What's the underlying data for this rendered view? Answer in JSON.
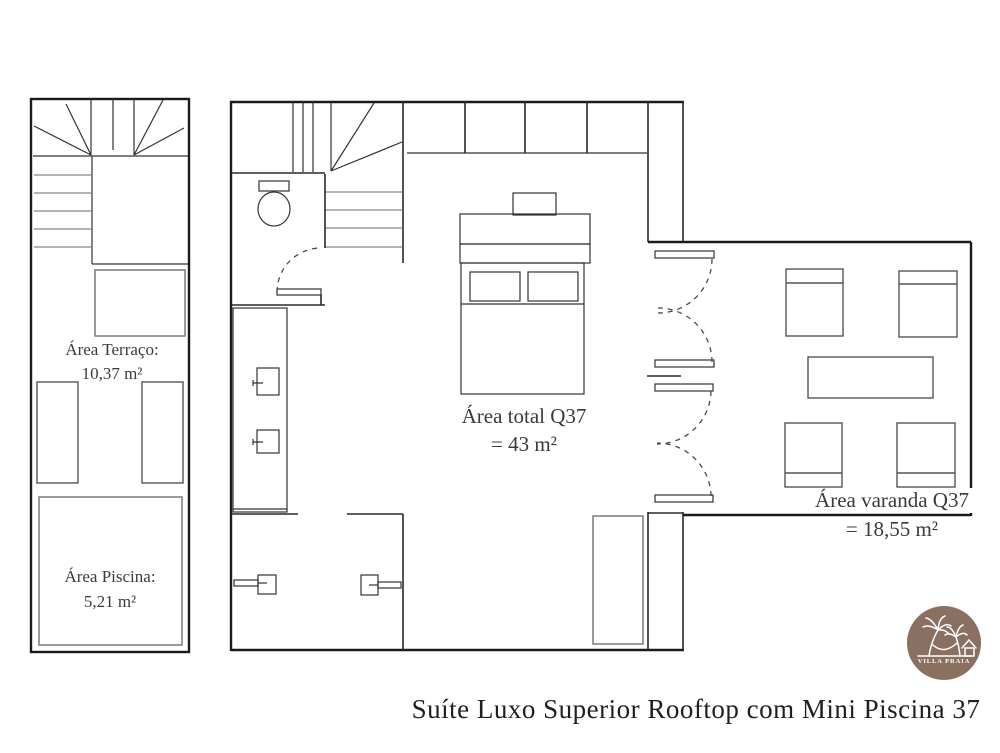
{
  "title": "Suíte Luxo Superior Rooftop com Mini Piscina 37",
  "areas": {
    "terrace": {
      "label": "Área Terraço:",
      "value": "10,37 m²"
    },
    "pool": {
      "label": "Área Piscina:",
      "value": "5,21 m²"
    },
    "suite_total": {
      "label": "Área total Q37",
      "value": "= 43 m²"
    },
    "veranda": {
      "label": "Área varanda Q37",
      "value": "= 18,55 m²"
    }
  },
  "logo": {
    "brand": "VILLA PRAIA",
    "icon": "palm-hammock-house-icon",
    "circle_color": "#8a7060",
    "icon_color": "#ffffff"
  },
  "colors": {
    "background": "#ffffff",
    "walls": "#1a1a1a",
    "interior_lines": "#2a2a2a",
    "furniture": "#555555",
    "light_fixtures": "#7a7a7a",
    "label_text": "#3a3a3a",
    "title_text": "#1f1f1f"
  }
}
